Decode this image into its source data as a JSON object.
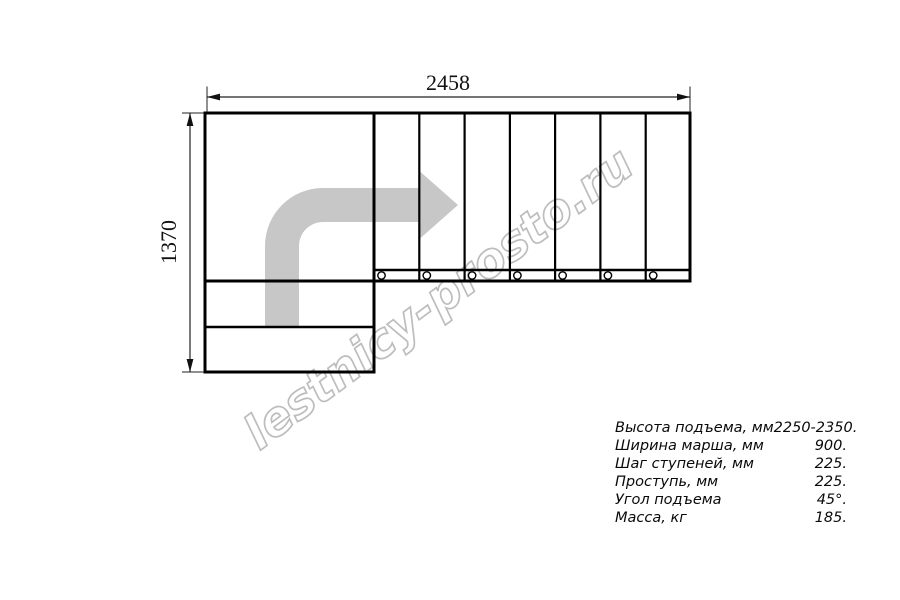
{
  "drawing": {
    "type": "staircase-plan-top-view",
    "dimensions": {
      "width_label": "2458",
      "height_label": "1370"
    },
    "watermark": "lestnicy-prosto.ru",
    "plan": {
      "tread_count": 7,
      "baluster_count": 7,
      "landing_lower_steps": 2,
      "turn_direction": "left-to-right quarter turn"
    },
    "colors": {
      "line": "#000000",
      "arrow_fill": "#c7c7c7",
      "watermark_stroke": "#bdbdbd",
      "background": "#ffffff"
    }
  },
  "specs": {
    "rows": [
      {
        "label": "Высота подъема, мм",
        "value": "2250-2350."
      },
      {
        "label": "Ширина марша, мм",
        "value": "900."
      },
      {
        "label": "Шаг ступеней, мм",
        "value": "225."
      },
      {
        "label": "Проступь, мм",
        "value": "225."
      },
      {
        "label": "Угол подъема",
        "value": "45°."
      },
      {
        "label": "Масса, кг",
        "value": "185."
      }
    ]
  }
}
